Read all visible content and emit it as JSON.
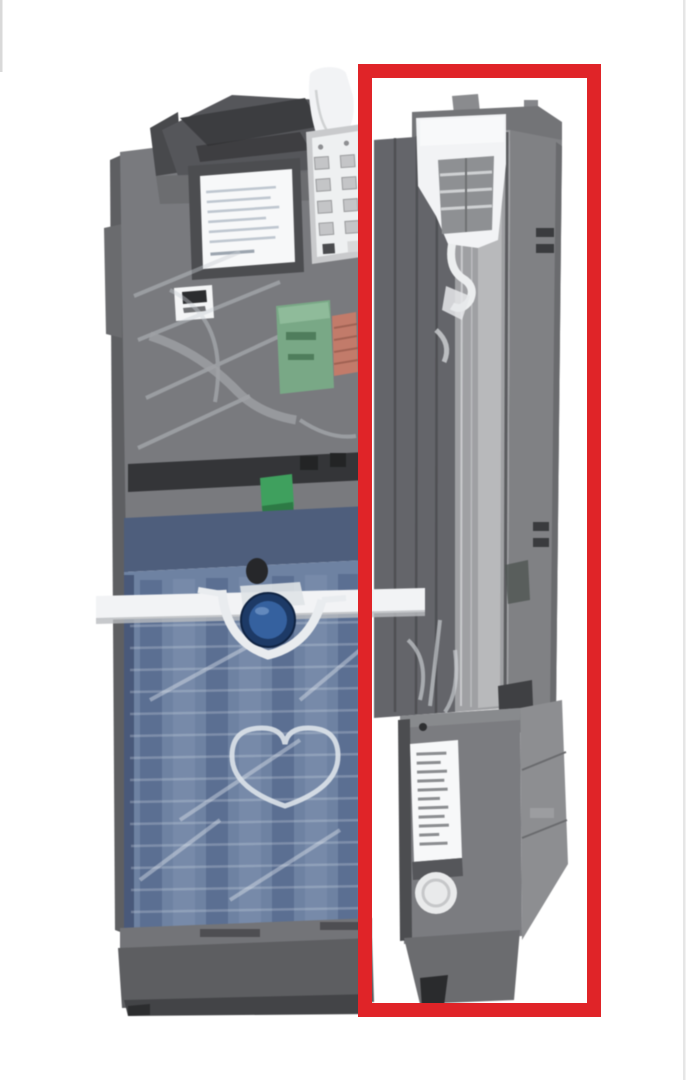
{
  "image": {
    "type": "annotated-product-photo",
    "subject": "Vending machine coin changer mechanism, three-quarter view, transparent housing showing internal coin paths",
    "background": "#ffffff"
  },
  "highlight": {
    "shape": "rectangle",
    "purpose": "red box highlighting the right-side coin-return channel module",
    "color": "#e02428",
    "x": 365,
    "y": 71,
    "width": 229,
    "height": 939,
    "stroke_width": 14
  },
  "colors": {
    "background": "#ffffff",
    "highlight_red": "#e02428",
    "body_gray": "#797a7e",
    "dark_gray": "#55565a",
    "flap_dark": "#3c3d40",
    "light_gray": "#9fa0a3",
    "silver": "#c9cacc",
    "white_part": "#f2f3f5",
    "label_white": "#f7f8f9",
    "cassette_blue": "#6e82a2",
    "cassette_blue_dark": "#4e5e7c",
    "cassette_blue_deep": "#54688c",
    "cassette_streak": "#e8edf3",
    "pcb_green": "#79a886",
    "connector_orange": "#c27b6a",
    "connector_green": "#3fa05e",
    "lens_blue_dark": "#1d3a66",
    "lens_blue": "#35619f",
    "frame_edge": "#dcdcdc"
  },
  "parts": {
    "unit": "coin-changer-unit",
    "hopper": "coin-insert-hopper",
    "funnel": "white-coin-funnel",
    "keypad": "settings-keypad-panel",
    "main_label": "instruction-label",
    "logo_label": "brand-logo-label",
    "pcb": "internal-pcb",
    "orange_connector": "edge-connector",
    "green_connector": "tube-sensor-connector",
    "cassette": "coin-tube-cassette",
    "retainer_bar": "tube-retainer-bar",
    "lens": "sensor-lens",
    "heart_guide": "coin-guide",
    "base": "base-pedestal",
    "tower": "coin-return-channel",
    "actuator": "return-actuator-mechanism",
    "module": "escrow-return-module",
    "module_label": "spec-label",
    "module_button": "round-button"
  }
}
